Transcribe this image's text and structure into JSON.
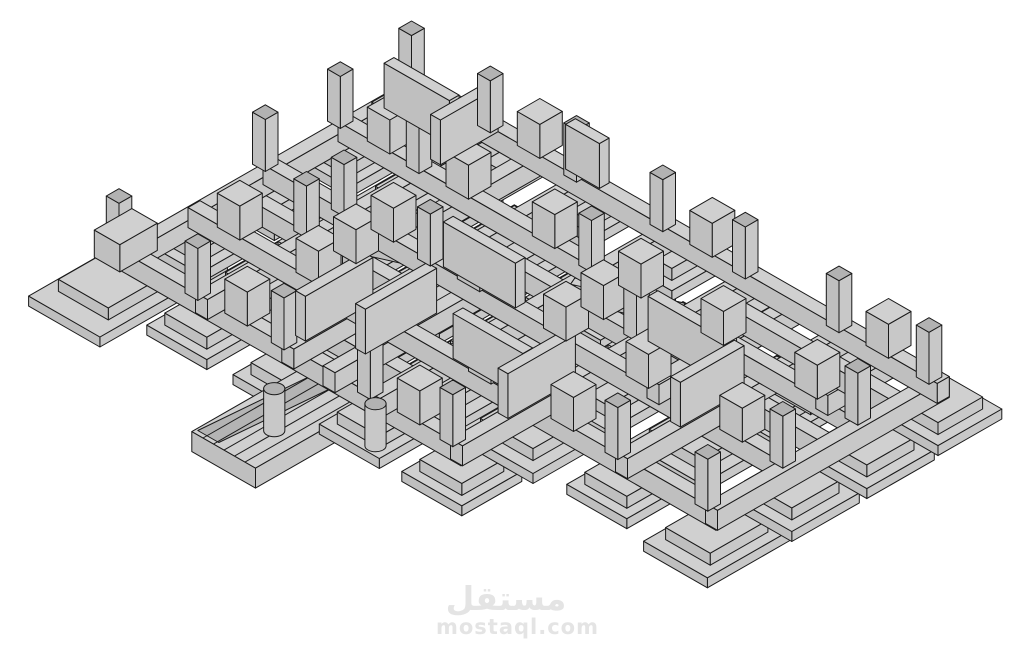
{
  "watermark": {
    "logo_text": "مستقل",
    "site_url": "mostaql.com",
    "color": "#e4e4e4"
  },
  "scene": {
    "projection": {
      "xs": 75,
      "ys": 43,
      "zs": 40,
      "ox": 128,
      "oy": 248
    },
    "palette": {
      "background": "#ffffff",
      "top": "#d0d0d0",
      "left": "#bfbfbf",
      "right": "#c8c8c8",
      "dark_top": "#b2b2b2",
      "slope": "#b4b4b4",
      "outline": "#1a1a1a"
    },
    "beam": {
      "w": 0.16,
      "z0": -0.5,
      "z1": 0
    },
    "beams_u": [
      {
        "v": 0.0,
        "a": -0.07,
        "b": 3.97
      },
      {
        "v": 1.05,
        "a": -0.07,
        "b": 3.97
      },
      {
        "v": 2.2,
        "a": -0.07,
        "b": 3.97
      },
      {
        "v": 3.35,
        "a": -0.07,
        "b": 3.97
      },
      {
        "v": 4.45,
        "a": -0.07,
        "b": 3.97
      },
      {
        "v": 5.7,
        "a": 0.88,
        "b": 3.97
      },
      {
        "v": 6.9,
        "a": 0.88,
        "b": 3.97
      },
      {
        "v": 1.6,
        "a": 1.95,
        "b": 3.97
      },
      {
        "v": 2.75,
        "a": -0.07,
        "b": 1.95
      },
      {
        "v": 5.05,
        "a": 1.95,
        "b": 3.97
      },
      {
        "v": 0.5,
        "a": 2.95,
        "b": 3.97
      },
      {
        "v": 6.3,
        "a": 2.95,
        "b": 3.97
      }
    ],
    "beams_v": [
      {
        "u": 0.0,
        "a": -0.07,
        "b": 4.52
      },
      {
        "u": 0.95,
        "a": -0.07,
        "b": 6.97
      },
      {
        "u": 1.95,
        "a": -0.07,
        "b": 6.97
      },
      {
        "u": 2.95,
        "a": -0.07,
        "b": 6.97
      },
      {
        "u": 3.9,
        "a": -0.07,
        "b": 6.97
      },
      {
        "u": 1.45,
        "a": -0.07,
        "b": 2.27
      },
      {
        "u": 2.45,
        "a": 2.2,
        "b": 4.52
      },
      {
        "u": 2.45,
        "a": 5.7,
        "b": 6.97
      },
      {
        "u": 3.4,
        "a": 4.45,
        "b": 6.97
      },
      {
        "u": 3.4,
        "a": -0.07,
        "b": 1.12
      },
      {
        "u": 0.45,
        "a": 2.2,
        "b": 3.42
      }
    ],
    "diag_w": 0.055,
    "diagonals": [
      {
        "u0": 1.45,
        "v0": 1.05,
        "u1": 1.95,
        "v1": 2.2
      },
      {
        "u0": 1.6,
        "v0": 1.05,
        "u1": 2.05,
        "v1": 2.13
      },
      {
        "u0": 2.45,
        "v0": 3.35,
        "u1": 2.95,
        "v1": 4.45
      },
      {
        "u0": 2.58,
        "v0": 3.35,
        "u1": 3.02,
        "v1": 4.38
      }
    ],
    "footings": {
      "t1h": 0.25,
      "t2h": 0.3,
      "t2s": 0.7,
      "ztop": -0.5,
      "items": [
        [
          0,
          0,
          1.7,
          0.95
        ],
        [
          0.95,
          0,
          0.8,
          0.8
        ],
        [
          1.95,
          0,
          0.8,
          0.8
        ],
        [
          2.95,
          0,
          0.8,
          0.8
        ],
        [
          3.9,
          0,
          0.8,
          0.8
        ],
        [
          0,
          1.05,
          0.8,
          0.8
        ],
        [
          0.95,
          1.05,
          1,
          1
        ],
        [
          1.95,
          1.05,
          1,
          1
        ],
        [
          2.95,
          1.05,
          1,
          1
        ],
        [
          3.9,
          1.05,
          0.8,
          0.8
        ],
        [
          1.45,
          1.05,
          0.65,
          0.65
        ],
        [
          0,
          2.2,
          0.8,
          0.8
        ],
        [
          0.95,
          2.2,
          1,
          1
        ],
        [
          1.95,
          2.2,
          1,
          1
        ],
        [
          2.95,
          2.2,
          1,
          1
        ],
        [
          3.9,
          2.2,
          0.8,
          0.8
        ],
        [
          0,
          3.35,
          0.8,
          0.8
        ],
        [
          0.95,
          3.35,
          1,
          1
        ],
        [
          1.95,
          3.35,
          1,
          1
        ],
        [
          2.95,
          3.35,
          1,
          1
        ],
        [
          3.9,
          3.35,
          0.8,
          0.8
        ],
        [
          2.45,
          3.35,
          0.65,
          0.65
        ],
        [
          0,
          4.45,
          0.8,
          0.8
        ],
        [
          0.95,
          4.45,
          1,
          1
        ],
        [
          1.95,
          4.45,
          1,
          1
        ],
        [
          2.95,
          4.45,
          1,
          1
        ],
        [
          3.9,
          4.45,
          0.8,
          0.8
        ],
        [
          2.45,
          4.45,
          0.6,
          0.6
        ],
        [
          0.95,
          5.7,
          0.8,
          0.8
        ],
        [
          1.95,
          5.7,
          1,
          1
        ],
        [
          2.95,
          5.7,
          1,
          1
        ],
        [
          3.9,
          5.7,
          0.8,
          0.8
        ],
        [
          3.4,
          5.7,
          0.6,
          0.6
        ],
        [
          0.95,
          6.9,
          1.1,
          0.85
        ],
        [
          1.95,
          6.9,
          0.9,
          0.9
        ],
        [
          2.95,
          6.9,
          0.9,
          0.9
        ],
        [
          3.9,
          6.9,
          0.85,
          0.85
        ]
      ]
    },
    "pedestals": {
      "s": 0.3,
      "z0": -0.5,
      "z1": 0.35,
      "dx": 0.27,
      "dy": 0.27,
      "nodes": [
        [
          0.95,
          1.05
        ],
        [
          1.95,
          1.05
        ],
        [
          2.95,
          1.05
        ],
        [
          1.95,
          2.2
        ],
        [
          2.95,
          2.2
        ],
        [
          0.95,
          3.35
        ],
        [
          1.95,
          3.35
        ],
        [
          2.95,
          3.35
        ],
        [
          0.95,
          4.45
        ],
        [
          1.95,
          4.45
        ],
        [
          2.95,
          4.45
        ],
        [
          1.95,
          5.7
        ],
        [
          2.95,
          5.7
        ],
        [
          0,
          1.05
        ],
        [
          0,
          3.35
        ],
        [
          0.95,
          0
        ],
        [
          2.95,
          0
        ],
        [
          3.9,
          1.05
        ],
        [
          3.9,
          3.35
        ],
        [
          3.9,
          5.7
        ],
        [
          2.45,
          3.35
        ],
        [
          1.45,
          1.05
        ]
      ]
    },
    "blocks": [
      {
        "u": 0.15,
        "v": -0.18,
        "su": 0.5,
        "sv": 0.34,
        "z0": -0.5,
        "z1": 0.18
      }
    ],
    "posts": {
      "s": 0.17,
      "z0": 0,
      "z1": 1.3,
      "dx": -0.06,
      "dy": -0.06,
      "nodes": [
        [
          0,
          0
        ],
        [
          1.95,
          0
        ],
        [
          2.95,
          0
        ],
        [
          3.9,
          0
        ],
        [
          0,
          1.05
        ],
        [
          0,
          2.2
        ],
        [
          0,
          3.35
        ],
        [
          0,
          4.45
        ],
        [
          3.9,
          1.05
        ],
        [
          3.9,
          2.2
        ],
        [
          3.9,
          3.35
        ],
        [
          3.9,
          4.45
        ],
        [
          3.9,
          5.7
        ],
        [
          3.9,
          6.9
        ],
        [
          0.95,
          6.9
        ],
        [
          1.95,
          6.9
        ],
        [
          2.95,
          6.9
        ],
        [
          1.95,
          2.2
        ],
        [
          2.95,
          3.35
        ],
        [
          1.45,
          1.05
        ],
        [
          2.45,
          4.45
        ],
        [
          0.95,
          5.7
        ],
        [
          2.95,
          1.05
        ],
        [
          1.95,
          1.05
        ],
        [
          0.95,
          2.2
        ]
      ]
    },
    "walls": {
      "w": 0.13,
      "h": 1.12,
      "items": [
        {
          "dir": "u",
          "at": 2.2,
          "a": 0.1,
          "b": 1.0
        },
        {
          "dir": "u",
          "at": 2.75,
          "a": 0.35,
          "b": 1.3
        },
        {
          "dir": "v",
          "at": 1.95,
          "a": 2.32,
          "b": 3.28
        },
        {
          "dir": "u",
          "at": 4.45,
          "a": 0.55,
          "b": 1.45
        },
        {
          "dir": "v",
          "at": 2.45,
          "a": 4.55,
          "b": 5.6
        },
        {
          "dir": "u",
          "at": 5.7,
          "a": 1.6,
          "b": 2.45
        },
        {
          "dir": "v",
          "at": 3.4,
          "a": 0.08,
          "b": 0.95
        },
        {
          "dir": "u",
          "at": 1.05,
          "a": 3.05,
          "b": 3.82
        },
        {
          "dir": "v",
          "at": 0.95,
          "a": 3.45,
          "b": 4.38
        },
        {
          "dir": "v",
          "at": 3.9,
          "a": 2.0,
          "b": 2.45
        }
      ]
    },
    "cylinders": {
      "r": 0.1,
      "z0": -0.75,
      "z1": 0.3,
      "items": [
        [
          -0.8,
          2.75
        ],
        [
          -0.3,
          3.6
        ]
      ]
    },
    "ramp": {
      "u0": -1.5,
      "u1": 0.0,
      "v0": 2.35,
      "v1": 3.2,
      "z0": -0.95,
      "z1": -0.45,
      "lines": [
        2.5,
        2.64,
        2.78,
        2.92,
        3.06
      ],
      "slope": [
        [
          -1.45,
          2.38
        ],
        [
          -0.05,
          2.5
        ],
        [
          -0.05,
          2.78
        ],
        [
          -1.45,
          2.66
        ]
      ]
    }
  }
}
